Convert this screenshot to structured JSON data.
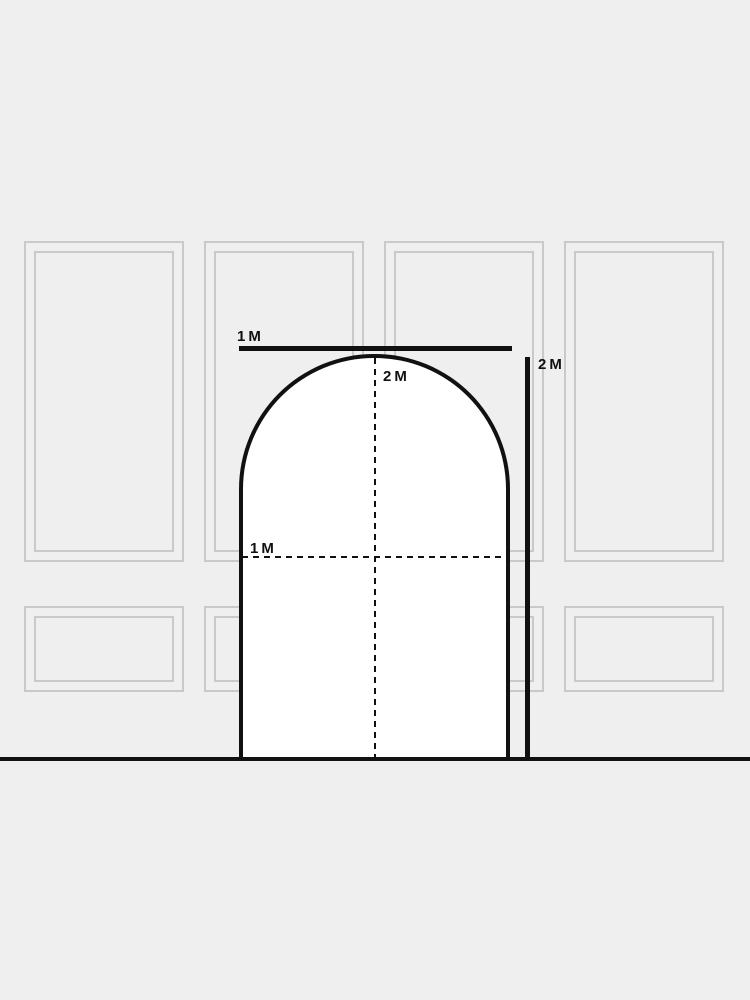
{
  "scene": {
    "background_color": "#efefef",
    "wall_panel_color": "#c9c9c9",
    "ink_color": "#111111",
    "door_fill_color": "#ffffff"
  },
  "wall": {
    "upper_panel_count": 4,
    "lower_panel_count": 4
  },
  "dimensions": {
    "door_width_label": "1M",
    "door_height_label": "2M",
    "side_height_label": "2M",
    "half_height_label": "1M"
  }
}
